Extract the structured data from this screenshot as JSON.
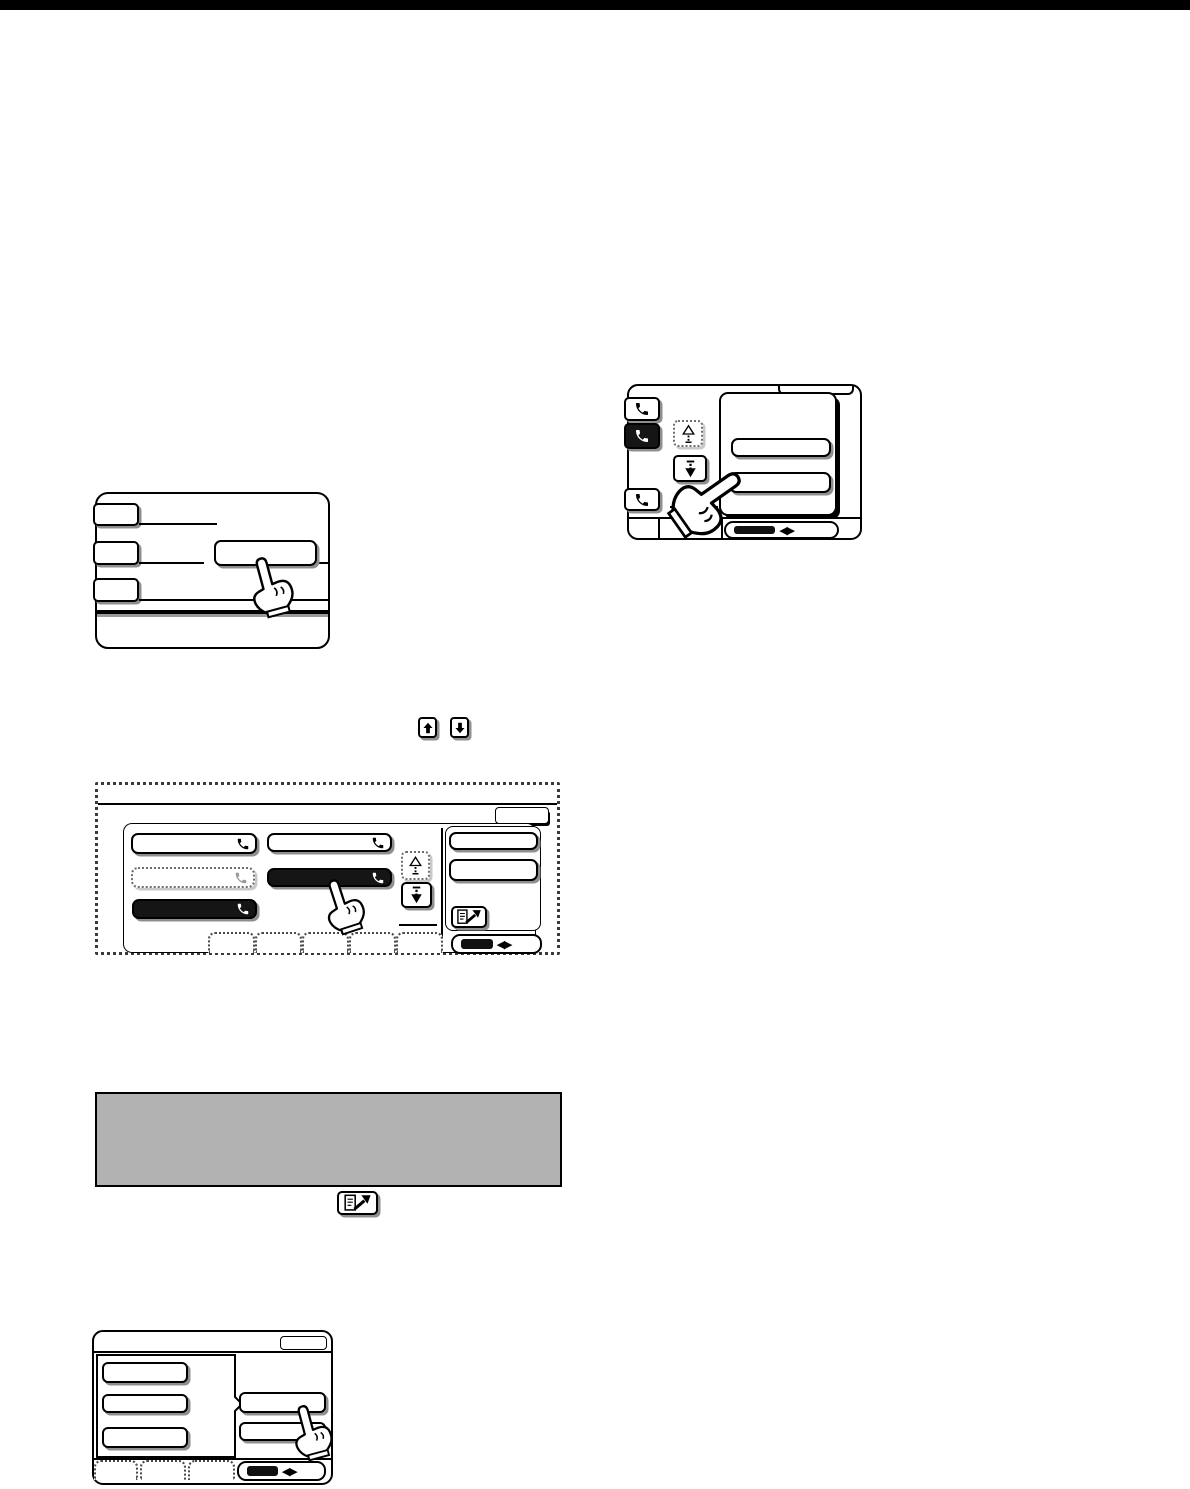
{
  "page": {
    "kind": "scanned fax/copier operation-manual page with touch-panel step illustrations",
    "background": "#ffffff",
    "top_rule_color": "#000000"
  },
  "colors": {
    "ink": "#000000",
    "key_shadow": "#8f8f8f",
    "selected_key_fill": "#151515",
    "dimmed_ink": "#9a9a9a",
    "note_box_fill": "#b2b2b2"
  },
  "glyphs": {
    "pager": "◀▶"
  },
  "figures": {
    "address_list_screen": {
      "index_keys": [
        {
          "icon": "phone-icon",
          "state": "normal"
        },
        {
          "icon": "phone-icon",
          "state": "selected"
        },
        {
          "icon": "phone-icon",
          "state": "normal"
        }
      ],
      "scroll_up_key": {
        "icon": "scroll-up-icon",
        "state": "disabled"
      },
      "scroll_down_key": {
        "icon": "scroll-down-icon",
        "state": "normal",
        "being_pressed": true
      },
      "destination_key_count": 2,
      "pager_key": {
        "icon": "left-right-arrows-icon"
      }
    },
    "condition_screen": {
      "left_key_count": 3,
      "text_rule_count": 3,
      "pressed_key_count": 1
    },
    "inline_keys": [
      {
        "icon": "up-arrow-key-icon"
      },
      {
        "icon": "down-arrow-key-icon"
      }
    ],
    "group_key_screen": {
      "column1_keys": [
        {
          "icon": "phone-icon",
          "state": "normal"
        },
        {
          "icon": "phone-icon",
          "state": "dimmed"
        },
        {
          "icon": "phone-icon",
          "state": "selected"
        }
      ],
      "column2_keys": [
        {
          "icon": "phone-icon",
          "state": "normal"
        },
        {
          "icon": "phone-icon",
          "state": "selected",
          "being_pressed": true
        }
      ],
      "scroll_up_key": {
        "icon": "scroll-up-icon",
        "state": "disabled"
      },
      "scroll_down_key": {
        "icon": "scroll-down-icon",
        "state": "normal"
      },
      "right_key_count": 2,
      "address_review_key": {
        "icon": "document-arrow-icon"
      },
      "bottom_tab_count": 5,
      "pager_key": {
        "icon": "left-right-arrows-icon"
      }
    },
    "note_box": {
      "fill": "#b2b2b2"
    },
    "inline_address_review_key": {
      "icon": "document-arrow-icon"
    },
    "dial_select_screen": {
      "left_key_count": 3,
      "right_key_count": 2,
      "pressed_right_key_index": 0,
      "bottom_tab_count": 3,
      "pager_key": {
        "icon": "left-right-arrows-icon"
      }
    }
  }
}
